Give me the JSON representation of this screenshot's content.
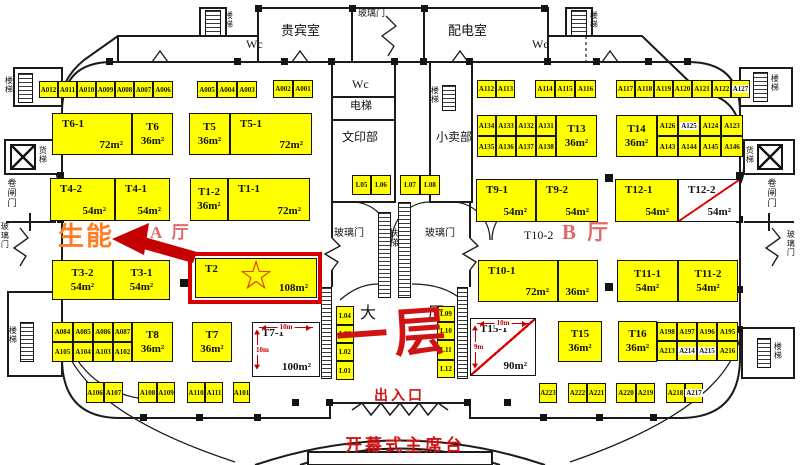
{
  "colors": {
    "booth_yellow": "#FFFF00",
    "line": "#1B1B1B",
    "highlight_red": "#D40000",
    "diag_red": "#E00000",
    "dim_red": "#C00000",
    "company_orange": "#FF7F27",
    "hall_red": "#E06A6A",
    "floor_red": "#CF1212"
  },
  "highlight": {
    "star_icon": "☆"
  },
  "booths": [
    {
      "label": "T6-1",
      "area": "72m²",
      "x": 52,
      "y": 113,
      "w": 80,
      "h": 42,
      "mode": "k"
    },
    {
      "label": "T6",
      "area": "36m²",
      "x": 132,
      "y": 113,
      "w": 41,
      "h": 42,
      "mode": "c"
    },
    {
      "label": "T5",
      "area": "36m²",
      "x": 189,
      "y": 113,
      "w": 41,
      "h": 42,
      "mode": "c"
    },
    {
      "label": "T5-1",
      "area": "72m²",
      "x": 230,
      "y": 113,
      "w": 82,
      "h": 42,
      "mode": "k"
    },
    {
      "label": "T4-2",
      "area": "54m²",
      "x": 50,
      "y": 178,
      "w": 65,
      "h": 43,
      "mode": "k"
    },
    {
      "label": "T4-1",
      "area": "54m²",
      "x": 115,
      "y": 178,
      "w": 55,
      "h": 43,
      "mode": "k"
    },
    {
      "label": "T1-2",
      "area": "36m²",
      "x": 190,
      "y": 178,
      "w": 38,
      "h": 43,
      "mode": "c"
    },
    {
      "label": "T1-1",
      "area": "72m²",
      "x": 228,
      "y": 178,
      "w": 82,
      "h": 43,
      "mode": "k"
    },
    {
      "label": "T3-2",
      "area": "54m²",
      "x": 52,
      "y": 260,
      "w": 61,
      "h": 40,
      "mode": "c"
    },
    {
      "label": "T3-1",
      "area": "54m²",
      "x": 113,
      "y": 260,
      "w": 57,
      "h": 40,
      "mode": "c"
    },
    {
      "label": "T2",
      "area": "108m²",
      "x": 195,
      "y": 258,
      "w": 122,
      "h": 40,
      "mode": "k",
      "star": true,
      "frame": true
    },
    {
      "label": "T8",
      "area": "36m²",
      "x": 132,
      "y": 322,
      "w": 41,
      "h": 40,
      "mode": "c"
    },
    {
      "label": "T7",
      "area": "36m²",
      "x": 192,
      "y": 322,
      "w": 40,
      "h": 40,
      "mode": "c"
    },
    {
      "label": "T7-1",
      "area": "100m²",
      "x": 252,
      "y": 322,
      "w": 68,
      "h": 55,
      "mode": "k",
      "white": true,
      "dims": {
        "top": "10m",
        "left": "10m"
      }
    },
    {
      "label": "T9-1",
      "area": "54m²",
      "x": 476,
      "y": 179,
      "w": 60,
      "h": 43,
      "mode": "k"
    },
    {
      "label": "T9-2",
      "area": "54m²",
      "x": 536,
      "y": 179,
      "w": 62,
      "h": 43,
      "mode": "k"
    },
    {
      "label": "T12-1",
      "area": "54m²",
      "x": 615,
      "y": 179,
      "w": 63,
      "h": 43,
      "mode": "k"
    },
    {
      "label": "T12-2",
      "area": "54m²",
      "x": 678,
      "y": 179,
      "w": 62,
      "h": 43,
      "mode": "k",
      "white": true,
      "diag": true
    },
    {
      "label": "T10-1",
      "area": "72m²",
      "x": 478,
      "y": 260,
      "w": 80,
      "h": 42,
      "mode": "k"
    },
    {
      "label": "",
      "area": "36m²",
      "x": 558,
      "y": 260,
      "w": 40,
      "h": 42,
      "mode": "k"
    },
    {
      "label": "T11-1",
      "area": "54m²",
      "x": 617,
      "y": 260,
      "w": 61,
      "h": 42,
      "mode": "c"
    },
    {
      "label": "T11-2",
      "area": "54m²",
      "x": 678,
      "y": 260,
      "w": 60,
      "h": 42,
      "mode": "c"
    },
    {
      "label": "T13",
      "area": "36m²",
      "x": 556,
      "y": 115,
      "w": 41,
      "h": 42,
      "mode": "c"
    },
    {
      "label": "T14",
      "area": "36m²",
      "x": 616,
      "y": 115,
      "w": 41,
      "h": 42,
      "mode": "c"
    },
    {
      "label": "T15",
      "area": "36m²",
      "x": 558,
      "y": 321,
      "w": 44,
      "h": 41,
      "mode": "c"
    },
    {
      "label": "T16",
      "area": "36m²",
      "x": 618,
      "y": 321,
      "w": 39,
      "h": 41,
      "mode": "c"
    },
    {
      "label": "T15-1",
      "area": "90m²",
      "x": 470,
      "y": 318,
      "w": 66,
      "h": 58,
      "mode": "k",
      "white": true,
      "diag": true,
      "dims": {
        "top": "10m",
        "left": "9m"
      }
    }
  ],
  "stalls": [
    {
      "label": "A012",
      "x": 39,
      "y": 81,
      "w": 19,
      "h": 17
    },
    {
      "label": "A011",
      "x": 58,
      "y": 81,
      "w": 19,
      "h": 17
    },
    {
      "label": "A010",
      "x": 77,
      "y": 81,
      "w": 19,
      "h": 17
    },
    {
      "label": "A009",
      "x": 96,
      "y": 81,
      "w": 19,
      "h": 17
    },
    {
      "label": "A008",
      "x": 115,
      "y": 81,
      "w": 19,
      "h": 17
    },
    {
      "label": "A007",
      "x": 134,
      "y": 81,
      "w": 19,
      "h": 17
    },
    {
      "label": "A006",
      "x": 153,
      "y": 81,
      "w": 20,
      "h": 17
    },
    {
      "label": "A005",
      "x": 197,
      "y": 81,
      "w": 20,
      "h": 17
    },
    {
      "label": "A004",
      "x": 217,
      "y": 81,
      "w": 20,
      "h": 17
    },
    {
      "label": "A003",
      "x": 237,
      "y": 81,
      "w": 20,
      "h": 17
    },
    {
      "label": "A002",
      "x": 273,
      "y": 80,
      "w": 20,
      "h": 18
    },
    {
      "label": "A001",
      "x": 293,
      "y": 80,
      "w": 20,
      "h": 18
    },
    {
      "label": "A112",
      "x": 477,
      "y": 80,
      "w": 19,
      "h": 18
    },
    {
      "label": "A113",
      "x": 496,
      "y": 80,
      "w": 19,
      "h": 18
    },
    {
      "label": "A114",
      "x": 535,
      "y": 80,
      "w": 20,
      "h": 18
    },
    {
      "label": "A115",
      "x": 555,
      "y": 80,
      "w": 20,
      "h": 18
    },
    {
      "label": "A116",
      "x": 575,
      "y": 80,
      "w": 21,
      "h": 18
    },
    {
      "label": "A117",
      "x": 616,
      "y": 80,
      "w": 19,
      "h": 18
    },
    {
      "label": "A118",
      "x": 635,
      "y": 80,
      "w": 19,
      "h": 18
    },
    {
      "label": "A119",
      "x": 654,
      "y": 80,
      "w": 19,
      "h": 18
    },
    {
      "label": "A120",
      "x": 673,
      "y": 80,
      "w": 19,
      "h": 18
    },
    {
      "label": "A121",
      "x": 692,
      "y": 80,
      "w": 20,
      "h": 18
    },
    {
      "label": "A122",
      "x": 712,
      "y": 80,
      "w": 19,
      "h": 18
    },
    {
      "label": "A127",
      "x": 731,
      "y": 80,
      "w": 19,
      "h": 18,
      "wl": true
    },
    {
      "label": "A134",
      "x": 477,
      "y": 115,
      "w": 19,
      "h": 21
    },
    {
      "label": "A133",
      "x": 496,
      "y": 115,
      "w": 20,
      "h": 21
    },
    {
      "label": "A132",
      "x": 516,
      "y": 115,
      "w": 20,
      "h": 21
    },
    {
      "label": "A131",
      "x": 536,
      "y": 115,
      "w": 20,
      "h": 21
    },
    {
      "label": "A135",
      "x": 477,
      "y": 136,
      "w": 19,
      "h": 21
    },
    {
      "label": "A136",
      "x": 496,
      "y": 136,
      "w": 20,
      "h": 21
    },
    {
      "label": "A137",
      "x": 516,
      "y": 136,
      "w": 20,
      "h": 21
    },
    {
      "label": "A138",
      "x": 536,
      "y": 136,
      "w": 20,
      "h": 21
    },
    {
      "label": "A126",
      "x": 657,
      "y": 115,
      "w": 21,
      "h": 21
    },
    {
      "label": "A125",
      "x": 678,
      "y": 115,
      "w": 22,
      "h": 21,
      "wl": true
    },
    {
      "label": "A124",
      "x": 700,
      "y": 115,
      "w": 21,
      "h": 21
    },
    {
      "label": "A123",
      "x": 721,
      "y": 115,
      "w": 22,
      "h": 21
    },
    {
      "label": "A143",
      "x": 657,
      "y": 136,
      "w": 21,
      "h": 21
    },
    {
      "label": "A144",
      "x": 678,
      "y": 136,
      "w": 22,
      "h": 21
    },
    {
      "label": "A145",
      "x": 700,
      "y": 136,
      "w": 21,
      "h": 21
    },
    {
      "label": "A146",
      "x": 721,
      "y": 136,
      "w": 22,
      "h": 21
    },
    {
      "label": "L05",
      "x": 352,
      "y": 175,
      "w": 19,
      "h": 20
    },
    {
      "label": "L06",
      "x": 371,
      "y": 175,
      "w": 20,
      "h": 20
    },
    {
      "label": "L07",
      "x": 400,
      "y": 175,
      "w": 20,
      "h": 20
    },
    {
      "label": "L08",
      "x": 420,
      "y": 175,
      "w": 20,
      "h": 20
    },
    {
      "label": "A084",
      "x": 52,
      "y": 322,
      "w": 21,
      "h": 20
    },
    {
      "label": "A085",
      "x": 73,
      "y": 322,
      "w": 20,
      "h": 20
    },
    {
      "label": "A086",
      "x": 93,
      "y": 322,
      "w": 20,
      "h": 20
    },
    {
      "label": "A087",
      "x": 113,
      "y": 322,
      "w": 19,
      "h": 20
    },
    {
      "label": "A105",
      "x": 52,
      "y": 342,
      "w": 21,
      "h": 20
    },
    {
      "label": "A104",
      "x": 73,
      "y": 342,
      "w": 20,
      "h": 20
    },
    {
      "label": "A103",
      "x": 93,
      "y": 342,
      "w": 20,
      "h": 20
    },
    {
      "label": "A102",
      "x": 113,
      "y": 342,
      "w": 19,
      "h": 20
    },
    {
      "label": "A106",
      "x": 86,
      "y": 382,
      "w": 18,
      "h": 21
    },
    {
      "label": "A107",
      "x": 104,
      "y": 382,
      "w": 19,
      "h": 21
    },
    {
      "label": "A108",
      "x": 138,
      "y": 382,
      "w": 19,
      "h": 21
    },
    {
      "label": "A109",
      "x": 157,
      "y": 382,
      "w": 18,
      "h": 21
    },
    {
      "label": "A110",
      "x": 187,
      "y": 382,
      "w": 18,
      "h": 21
    },
    {
      "label": "A111",
      "x": 205,
      "y": 382,
      "w": 18,
      "h": 21
    },
    {
      "label": "A101",
      "x": 233,
      "y": 382,
      "w": 17,
      "h": 21
    },
    {
      "label": "L04",
      "x": 336,
      "y": 306,
      "w": 18,
      "h": 19
    },
    {
      "label": "L03",
      "x": 336,
      "y": 325,
      "w": 18,
      "h": 18
    },
    {
      "label": "L02",
      "x": 336,
      "y": 343,
      "w": 18,
      "h": 18
    },
    {
      "label": "L01",
      "x": 336,
      "y": 361,
      "w": 18,
      "h": 19
    },
    {
      "label": "L09",
      "x": 437,
      "y": 306,
      "w": 18,
      "h": 16
    },
    {
      "label": "L10",
      "x": 437,
      "y": 322,
      "w": 18,
      "h": 18
    },
    {
      "label": "L11",
      "x": 437,
      "y": 340,
      "w": 18,
      "h": 20
    },
    {
      "label": "L12",
      "x": 437,
      "y": 360,
      "w": 18,
      "h": 18
    },
    {
      "label": "A198",
      "x": 657,
      "y": 322,
      "w": 20,
      "h": 19
    },
    {
      "label": "A197",
      "x": 677,
      "y": 322,
      "w": 20,
      "h": 19
    },
    {
      "label": "A196",
      "x": 697,
      "y": 322,
      "w": 20,
      "h": 19
    },
    {
      "label": "A195",
      "x": 717,
      "y": 322,
      "w": 21,
      "h": 19
    },
    {
      "label": "A213",
      "x": 657,
      "y": 341,
      "w": 20,
      "h": 20
    },
    {
      "label": "A214",
      "x": 677,
      "y": 341,
      "w": 20,
      "h": 20,
      "wl": true
    },
    {
      "label": "A215",
      "x": 697,
      "y": 341,
      "w": 20,
      "h": 20,
      "wl": true
    },
    {
      "label": "A216",
      "x": 717,
      "y": 341,
      "w": 21,
      "h": 20
    },
    {
      "label": "A223",
      "x": 539,
      "y": 383,
      "w": 18,
      "h": 20
    },
    {
      "label": "A222",
      "x": 568,
      "y": 383,
      "w": 19,
      "h": 20
    },
    {
      "label": "A221",
      "x": 587,
      "y": 383,
      "w": 19,
      "h": 20
    },
    {
      "label": "A220",
      "x": 616,
      "y": 383,
      "w": 20,
      "h": 20
    },
    {
      "label": "A219",
      "x": 636,
      "y": 383,
      "w": 19,
      "h": 20
    },
    {
      "label": "A218",
      "x": 666,
      "y": 383,
      "w": 19,
      "h": 20
    },
    {
      "label": "A217",
      "x": 685,
      "y": 383,
      "w": 18,
      "h": 20,
      "wl": true
    }
  ],
  "rooms": [
    {
      "label": "贵宾室",
      "x": 281,
      "y": 24,
      "fs": 13
    },
    {
      "label": "配电室",
      "x": 448,
      "y": 24,
      "fs": 13
    },
    {
      "label": "玻璃门",
      "x": 358,
      "y": 9,
      "fs": 9
    },
    {
      "label": "Wc",
      "x": 246,
      "y": 38,
      "fs": 12
    },
    {
      "label": "Wc",
      "x": 532,
      "y": 38,
      "fs": 12
    },
    {
      "label": "Wc",
      "x": 352,
      "y": 78,
      "fs": 12
    },
    {
      "label": "电梯",
      "x": 350,
      "y": 101,
      "fs": 11
    },
    {
      "label": "文印部",
      "x": 342,
      "y": 131,
      "fs": 12
    },
    {
      "label": "小卖部",
      "x": 436,
      "y": 131,
      "fs": 12
    },
    {
      "label": "扶梯",
      "x": 388,
      "y": 228,
      "fs": 9,
      "v": true
    },
    {
      "label": "玻璃门",
      "x": 334,
      "y": 229,
      "fs": 10
    },
    {
      "label": "玻璃门",
      "x": 425,
      "y": 229,
      "fs": 10
    },
    {
      "label": "大",
      "x": 360,
      "y": 306,
      "fs": 16
    },
    {
      "label": "厅",
      "x": 428,
      "y": 306,
      "fs": 16
    },
    {
      "label": "楼梯",
      "x": 224,
      "y": 11,
      "fs": 8,
      "v": true
    },
    {
      "label": "楼梯",
      "x": 589,
      "y": 11,
      "fs": 8,
      "v": true
    },
    {
      "label": "楼梯",
      "x": 430,
      "y": 86,
      "fs": 8,
      "v": true
    },
    {
      "label": "楼梯",
      "x": 770,
      "y": 74,
      "fs": 8,
      "v": true
    },
    {
      "label": "楼梯",
      "x": 4,
      "y": 76,
      "fs": 8,
      "v": true
    },
    {
      "label": "楼梯",
      "x": 8,
      "y": 326,
      "fs": 8,
      "v": true
    },
    {
      "label": "楼梯",
      "x": 773,
      "y": 342,
      "fs": 8,
      "v": true
    },
    {
      "label": "货梯",
      "x": 38,
      "y": 146,
      "fs": 8,
      "v": true
    },
    {
      "label": "货梯",
      "x": 745,
      "y": 146,
      "fs": 8,
      "v": true
    },
    {
      "label": "卷闸门",
      "x": 6,
      "y": 178,
      "fs": 9,
      "v": true
    },
    {
      "label": "卷闸门",
      "x": 766,
      "y": 178,
      "fs": 9,
      "v": true
    },
    {
      "label": "玻璃门",
      "x": 0,
      "y": 222,
      "fs": 8,
      "v": true
    },
    {
      "label": "玻璃门",
      "x": 786,
      "y": 230,
      "fs": 8,
      "v": true
    }
  ],
  "annotations": [
    {
      "text": "生能",
      "x": 58,
      "y": 224,
      "fs": 26,
      "cls": "company",
      "name": "company-highlight-text"
    },
    {
      "text": "A 厅",
      "x": 150,
      "y": 224,
      "fs": 17,
      "cls": "hall",
      "name": "hall-a-label"
    },
    {
      "text": "B 厅",
      "x": 562,
      "y": 222,
      "fs": 21,
      "cls": "hall",
      "name": "hall-b-label"
    },
    {
      "text": "T10-2",
      "x": 524,
      "y": 229,
      "fs": 12,
      "cls": "black",
      "name": "t10-2-label"
    },
    {
      "text": "一层",
      "x": 336,
      "y": 310,
      "fs": 52,
      "cls": "floor",
      "name": "floor-one-annotation"
    },
    {
      "text": "出入口",
      "x": 374,
      "y": 390,
      "fs": 14,
      "cls": "redtext",
      "name": "entrance-exit-label"
    },
    {
      "text": "开幕式主席台",
      "x": 345,
      "y": 437,
      "fs": 17,
      "cls": "redtext",
      "name": "rostrum-label"
    }
  ]
}
